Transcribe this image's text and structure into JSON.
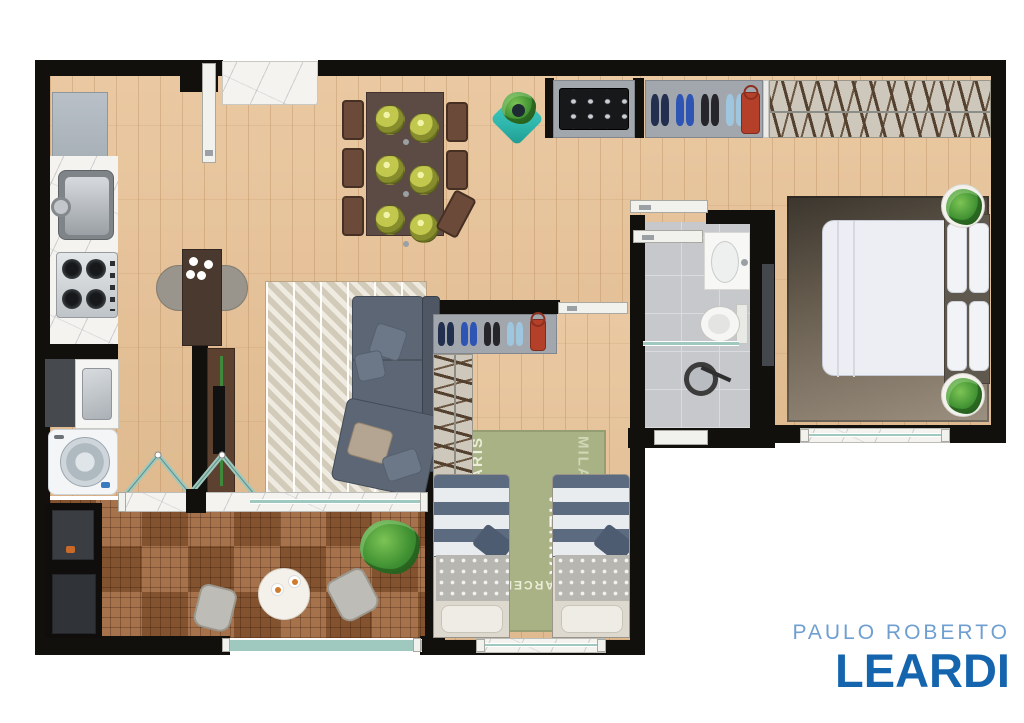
{
  "brand": {
    "line1": "PAULO ROBERTO",
    "line2": "LEARDI"
  },
  "palette": {
    "brand_light": "#6f9fd0",
    "brand_dark": "#1565ae",
    "wall": "#12100d",
    "wood": "#e8c49a",
    "deck": "#9c6238",
    "tile": "#c6c8cc",
    "glass": "#9fc8be",
    "marble": "#f4f3f0",
    "sofa": "#5c6674",
    "rug_b2": "#a9b284",
    "island": "#4a392e",
    "tv_wood": "#5d4130",
    "table": "#5c4a45",
    "chair": "#6b4a39",
    "planter": "#2fb7ad",
    "shelf": "#a2a7ae",
    "hanger_bg": "#cdc8bb",
    "hanger_line": "#8d8d88",
    "bag": "#b5402a",
    "stripe_blue": "#5c6b80",
    "stripe_white": "#e9ecef",
    "blanket": "#b7b6b1"
  },
  "closet_main_shoes": [
    "#232f4e",
    "#2f55b4",
    "#26262a",
    "#9fc6df"
  ],
  "closet_b2_shoes": [
    "#232f4e",
    "#2f55b4",
    "#26262a",
    "#9fc6df"
  ],
  "rug_words": [
    "PARIS",
    "VIENNA",
    "BARCELONA",
    "MILAN",
    "NEW·YORK",
    "SYDNEY",
    "BERLIN",
    "ROME",
    "LONDON",
    "BOSTON",
    "SAN FRANCISCO",
    "HELSINKI",
    "MELBOURNE",
    "FRANKFURT",
    "CAPE TOWN"
  ]
}
